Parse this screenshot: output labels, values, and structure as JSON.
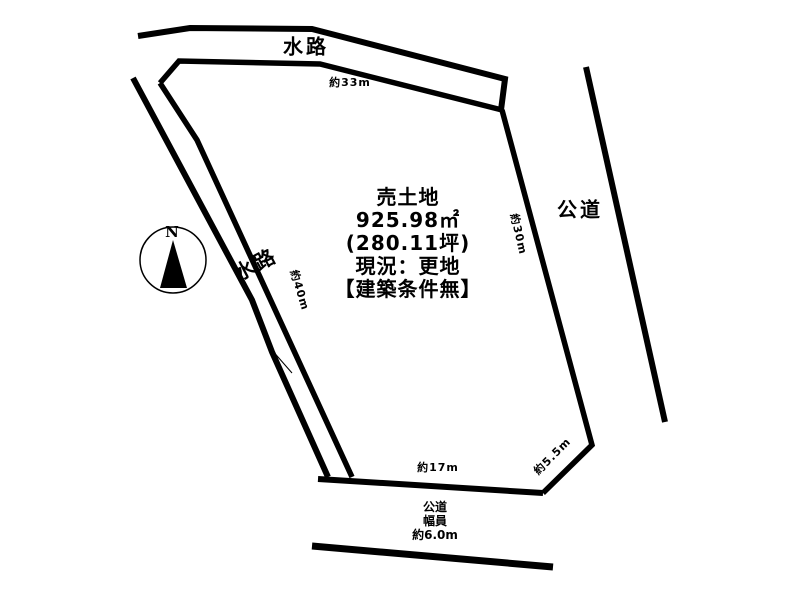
{
  "diagram": {
    "background_color": "#ffffff",
    "line_color": "#000000",
    "parcel": {
      "title": "売土地",
      "area_m2": "925.98㎡",
      "area_tsubo": "(280.11坪)",
      "current_state": "現況：更地",
      "conditions": "【建築条件無】"
    },
    "labels": {
      "waterway_top": "水路",
      "waterway_left": "水路",
      "road_right": "公道",
      "road_bottom_line1": "公道",
      "road_bottom_line2": "幅員",
      "road_bottom_line3": "約6.0m",
      "compass_north": "N"
    },
    "dimensions": {
      "top_edge": "約33m",
      "right_edge": "約30m",
      "left_edge": "約40m",
      "bottom_edge": "約17m",
      "bottom_right_edge": "約5.5m"
    }
  }
}
